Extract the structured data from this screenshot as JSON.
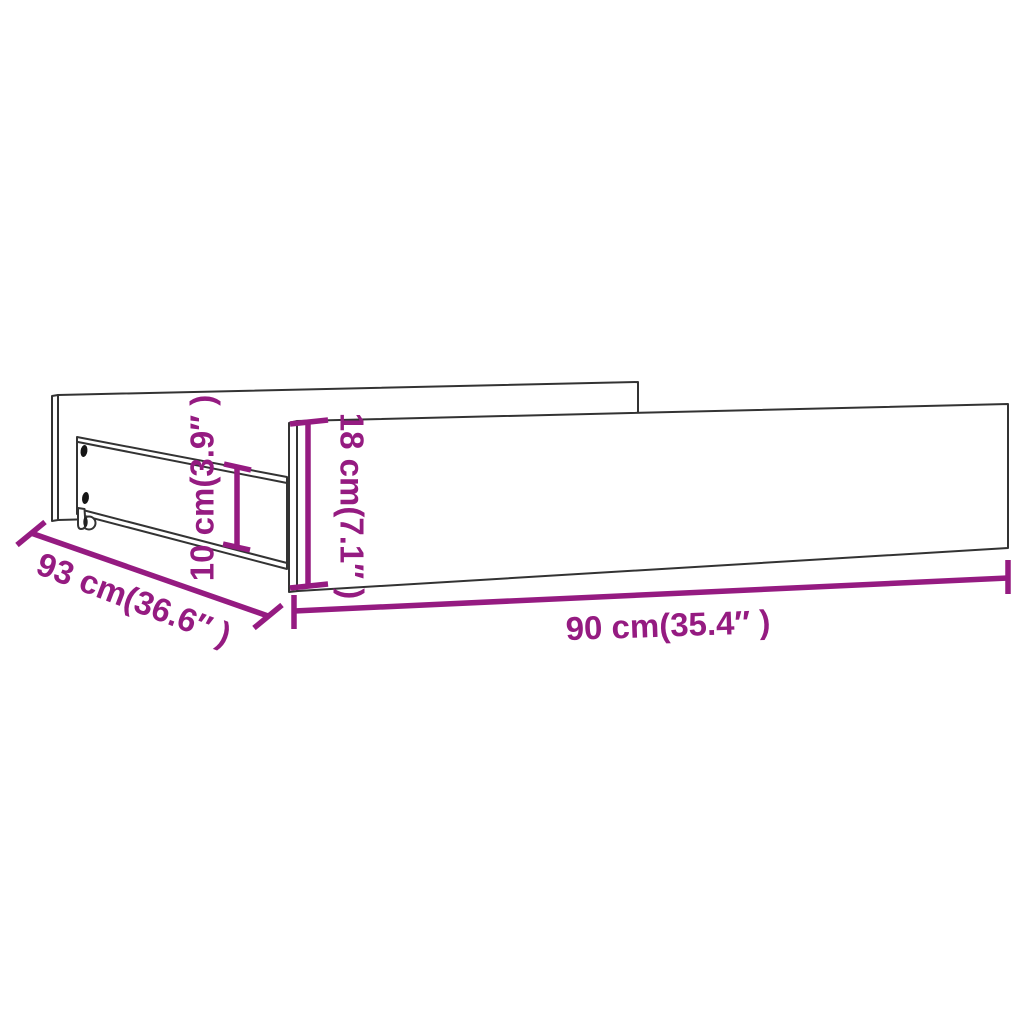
{
  "image": {
    "background": "#ffffff",
    "description": "Technical line drawing of an under-bed storage drawer with two casters and screw holes, annotated with four dimension lines"
  },
  "colors": {
    "accent": "#951b81",
    "outline": "#333333"
  },
  "dimensions": {
    "front_height": {
      "label": "18 cm(7.1″ )",
      "cm": "18",
      "inches": "7.1",
      "orientation": "vertical"
    },
    "side_height": {
      "label": "10 cm(3.9″ )",
      "cm": "10",
      "inches": "3.9",
      "orientation": "vertical"
    },
    "depth": {
      "label": "93 cm(36.6″ )",
      "cm": "93",
      "inches": "36.6",
      "orientation": "diagonal"
    },
    "width": {
      "label": "90 cm(35.4″ )",
      "cm": "90",
      "inches": "35.4",
      "orientation": "horizontal"
    }
  }
}
